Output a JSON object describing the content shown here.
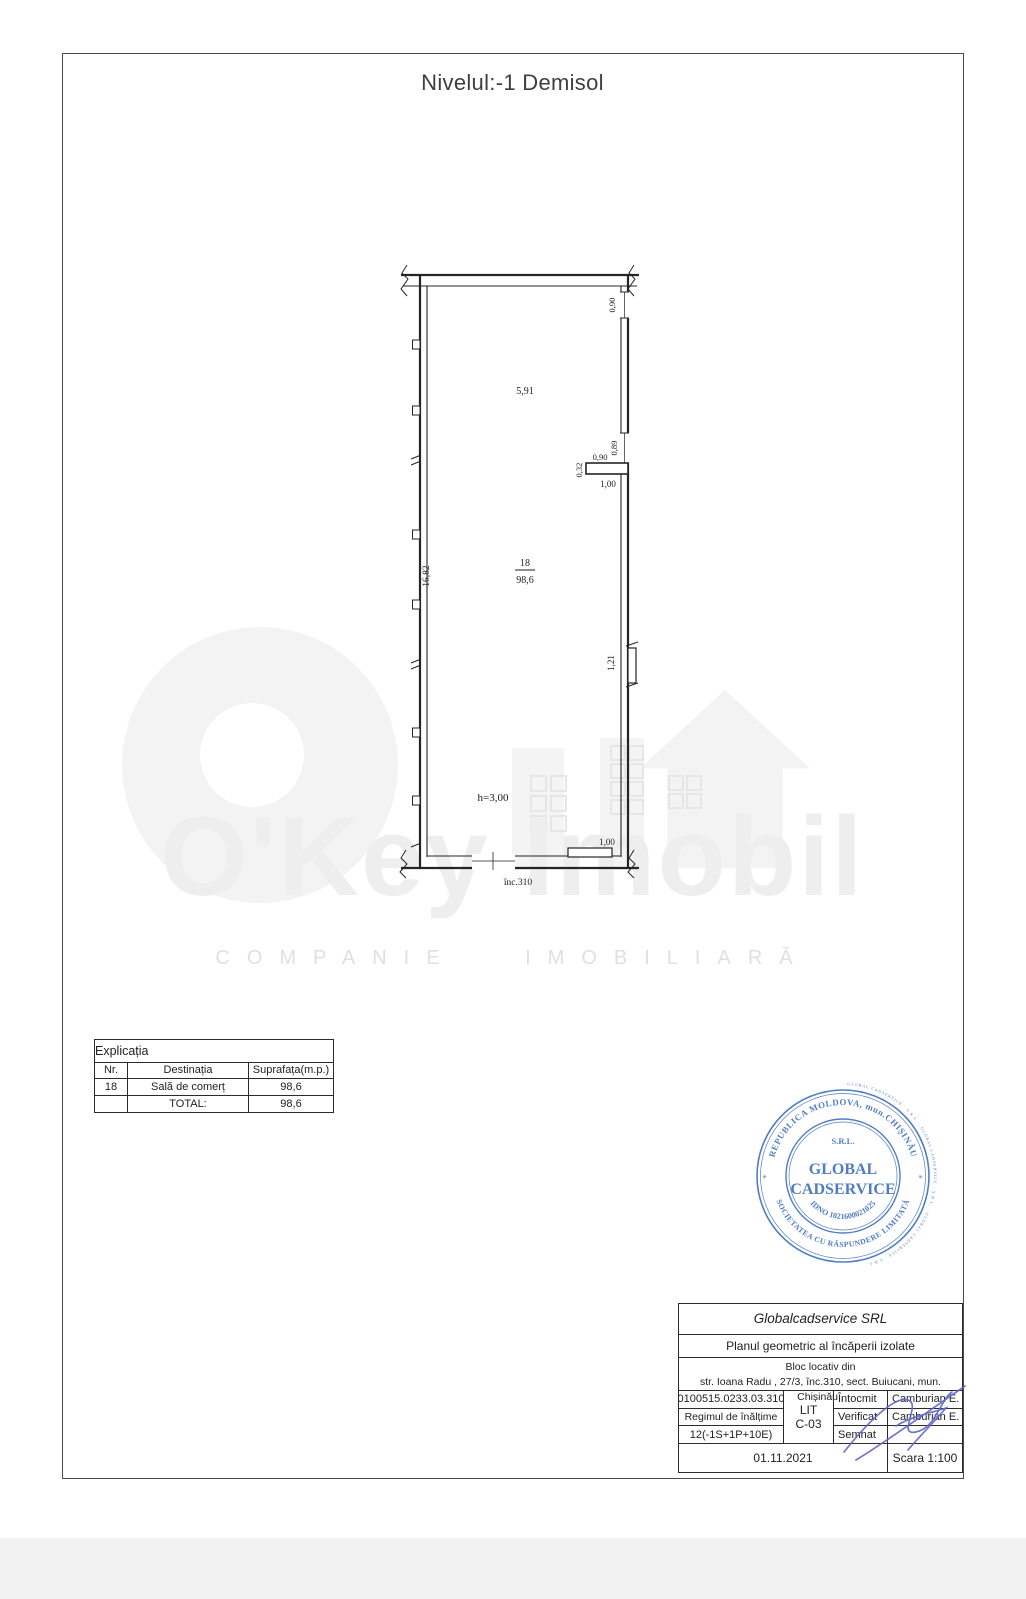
{
  "document": {
    "title": "Nivelul:-1 Demisol"
  },
  "plan": {
    "room_number": "18",
    "room_area": "98,6",
    "height_note": "h=3,00",
    "door_label": "înc.310",
    "dims": {
      "top_right_opening": "0,90",
      "upper_width": "5,91",
      "left_height": "16,82",
      "stub_opening_a": "0,90",
      "stub_opening_b": "0,89",
      "stub_thickness": "0,32",
      "stub_length": "1,00",
      "right_pilaster": "1,21",
      "bottom_right_step": "1,00"
    }
  },
  "legend": {
    "title": "Explicația",
    "columns": {
      "nr": "Nr.",
      "dest": "Destinația",
      "area": "Suprafața(m.p.)"
    },
    "rows": [
      {
        "nr": "18",
        "dest": "Sală de comerț",
        "area": "98,6"
      },
      {
        "nr": "",
        "dest": "TOTAL:",
        "area": "98,6"
      }
    ]
  },
  "stamp": {
    "color": "#4273c0",
    "micro_ring": "· GLOBAL CADSERVICE · S.R.L. · GLOBAL CADSERVICE · S.R.L. · GLOBAL CADSERVICE · S.R.L. ·",
    "ring_top": "REPUBLICA MOLDOVA, mun.CHIȘINĂU",
    "ring_bottom": "SOCIETATEA CU RĂSPUNDERE LIMITATĂ",
    "star_left": "✳",
    "star_right": "✳",
    "srl": "S.R.L.",
    "name1": "GLOBAL",
    "name2": "CADSERVICE",
    "idno": "IDNO 1021600021025"
  },
  "title_block": {
    "company": "Globalcadservice SRL",
    "doc_type": "Planul geometric al încăperii izolate",
    "object_line1": "Bloc locativ din",
    "object_line2": "str. Ioana Radu , 27/3, înc.310, sect. Buiucani, mun. Chișinău ,",
    "cadastral_number": "0100515.0233.03.310",
    "height_regime_label": "Regimul de înălțime",
    "height_regime_value": "12(-1S+1P+10E)",
    "lit_label": "LIT",
    "lit_value": "C-03",
    "sign_rows": [
      {
        "label": "Întocmit",
        "name": "Camburian E."
      },
      {
        "label": "Verificat",
        "name": "Camburian E."
      },
      {
        "label": "Semnat",
        "name": ""
      }
    ],
    "date": "01.11.2021",
    "scale": "Scara 1:100"
  },
  "watermark": {
    "brand": "O'Key Imobil",
    "tagline": "COMPANIE IMOBILIARĂ"
  }
}
